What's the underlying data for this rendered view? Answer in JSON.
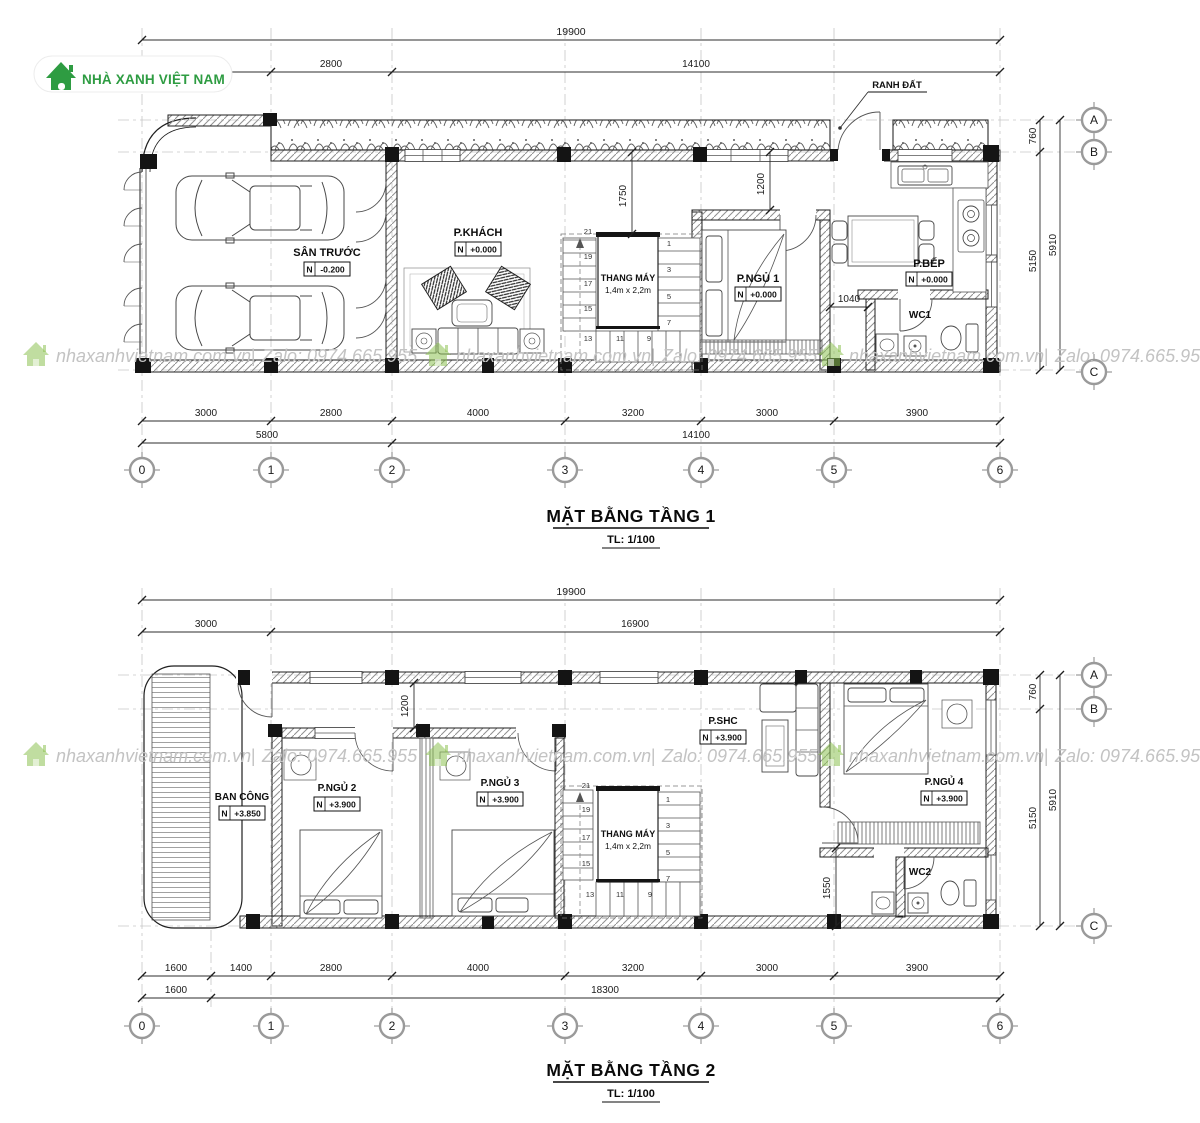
{
  "brand": {
    "name": "NHÀ XANH VIỆT NAM"
  },
  "watermark": {
    "site": "nhaxanhvietnam.com.vn",
    "sep": "|",
    "zalo": "Zalo: 0974.665.955"
  },
  "grid": {
    "cols": [
      "0",
      "1",
      "2",
      "3",
      "4",
      "5",
      "6"
    ],
    "rows": [
      "A",
      "B",
      "C"
    ]
  },
  "colors": {
    "brand_green": "#2e9c42",
    "line": "#1f1f1f",
    "watermark_gray": "#c3c3c3"
  },
  "floor1": {
    "title": "MẶT BẰNG TẦNG 1",
    "scale": "TL: 1/100",
    "land_boundary": "RANH ĐẤT",
    "dims": {
      "total_top": "19900",
      "top": [
        "3000",
        "2800",
        "14100"
      ],
      "bottom": [
        "3000",
        "2800",
        "4000",
        "3200",
        "3000",
        "3900"
      ],
      "bottom_totals": [
        "5800",
        "14100"
      ],
      "right": [
        "760",
        "5150"
      ],
      "right_total": "5910",
      "elevator_clear": "1750",
      "bedroom_clear": "1200",
      "wc_clear": "1040"
    },
    "rooms": {
      "yard": {
        "name": "SÂN TRƯỚC",
        "datum": "N",
        "level": "-0.200"
      },
      "living": {
        "name": "P.KHÁCH",
        "datum": "N",
        "level": "+0.000"
      },
      "bedroom1": {
        "name": "P.NGỦ 1",
        "datum": "N",
        "level": "+0.000"
      },
      "kitchen": {
        "name": "P.BẾP",
        "datum": "N",
        "level": "+0.000"
      },
      "wc": {
        "name": "WC1"
      },
      "elevator": {
        "name": "THANG MÁY",
        "size": "1,4m x 2,2m"
      }
    },
    "stairs": {
      "left": [
        "21",
        "19",
        "17",
        "15"
      ],
      "bottom": [
        "13",
        "11",
        "9"
      ],
      "right": [
        "1",
        "3",
        "5",
        "7"
      ]
    }
  },
  "floor2": {
    "title": "MẶT BẰNG TẦNG 2",
    "scale": "TL: 1/100",
    "dims": {
      "total_top": "19900",
      "top": [
        "3000",
        "16900"
      ],
      "bottom": [
        "1600",
        "1400",
        "2800",
        "4000",
        "3200",
        "3000",
        "3900"
      ],
      "bottom_totals": [
        "1600",
        "18300"
      ],
      "right": [
        "760",
        "5150"
      ],
      "right_total": "5910",
      "strip_clear": "1200",
      "wc_clear": "1550"
    },
    "rooms": {
      "balcony": {
        "name": "BAN CÔNG",
        "datum": "N",
        "level": "+3.850"
      },
      "bedroom2": {
        "name": "P.NGỦ 2",
        "datum": "N",
        "level": "+3.900"
      },
      "bedroom3": {
        "name": "P.NGỦ 3",
        "datum": "N",
        "level": "+3.900"
      },
      "family": {
        "name": "P.SHC",
        "datum": "N",
        "level": "+3.900"
      },
      "bedroom4": {
        "name": "P.NGỦ 4",
        "datum": "N",
        "level": "+3.900"
      },
      "wc": {
        "name": "WC2"
      },
      "elevator": {
        "name": "THANG MÁY",
        "size": "1,4m x 2,2m"
      }
    },
    "stairs": {
      "left": [
        "21",
        "19",
        "17",
        "15"
      ],
      "bottom": [
        "13",
        "11",
        "9"
      ],
      "right": [
        "1",
        "3",
        "5",
        "7"
      ]
    }
  }
}
